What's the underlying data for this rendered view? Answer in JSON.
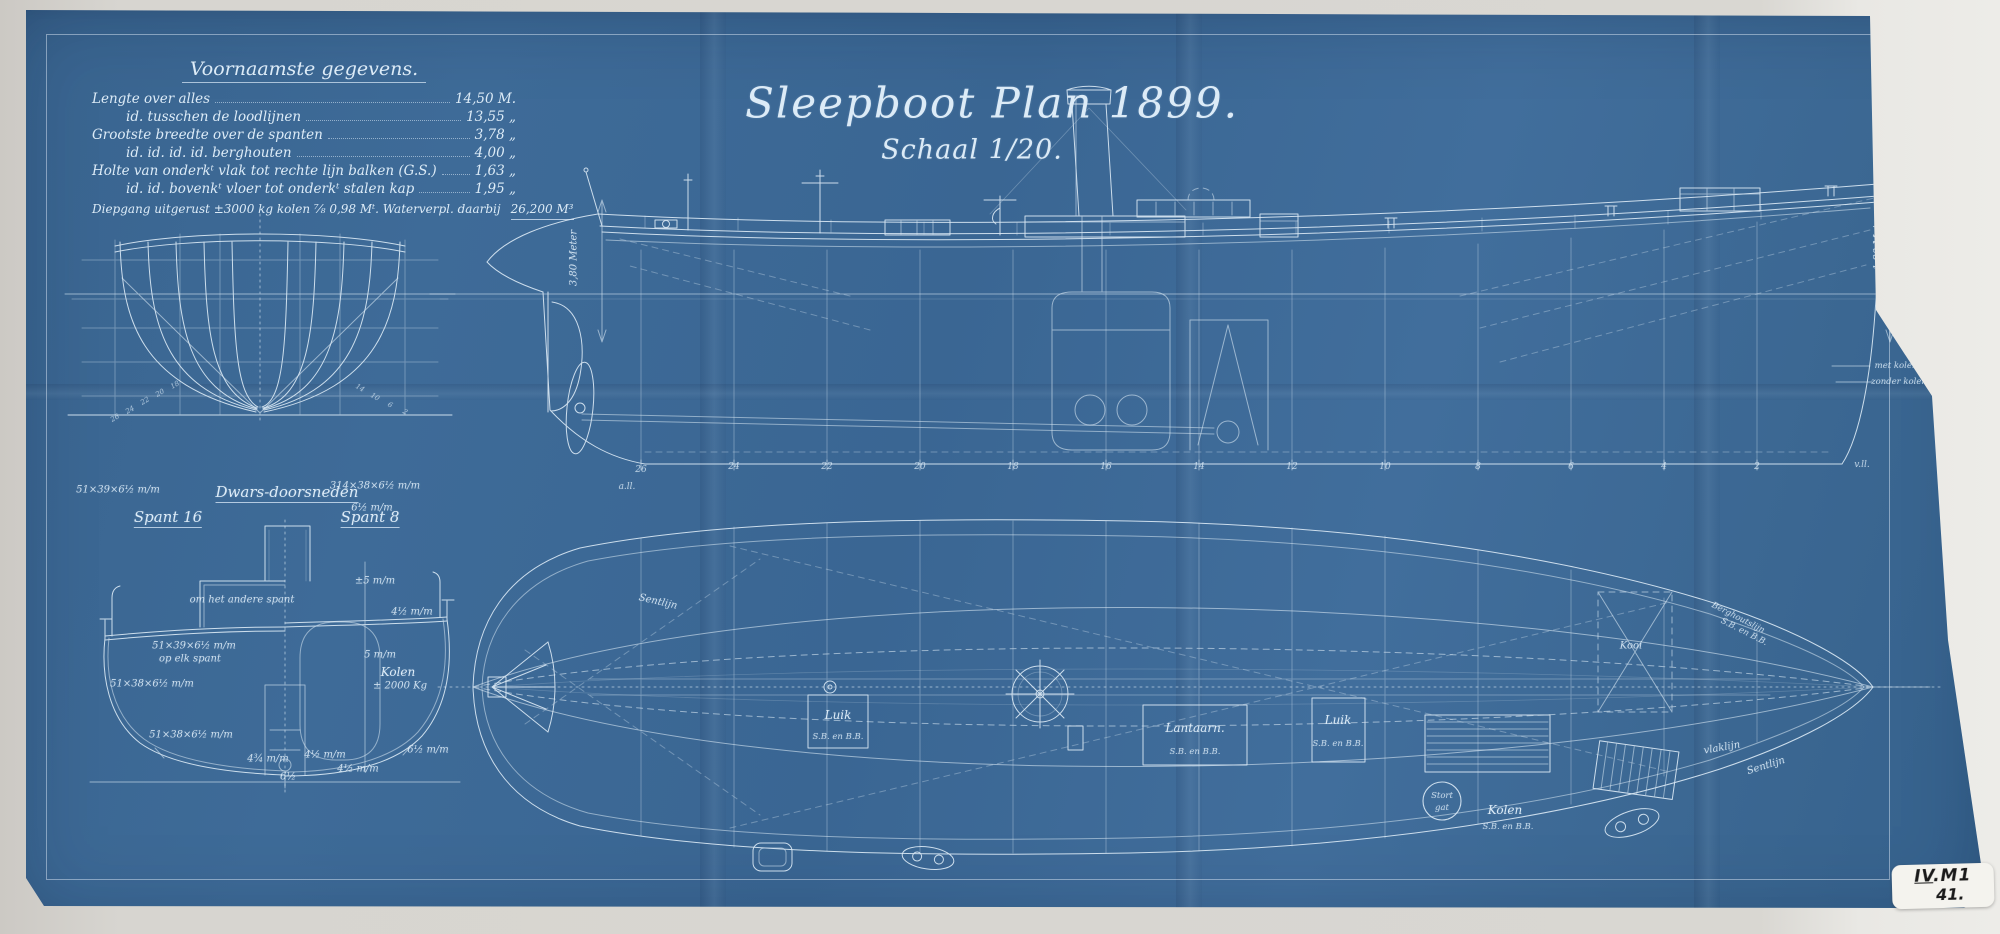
{
  "colors": {
    "paper": "#d9d7d2",
    "blueprint": "#3e6b98",
    "ink": "#dcebf7"
  },
  "title_block": {
    "line1": "Sleepboot Plan 1899.",
    "line2": "Schaal 1/20."
  },
  "data_table": {
    "title": "Voornaamste gegevens.",
    "rows": [
      {
        "label": "Lengte over alles",
        "value": "14,50 M."
      },
      {
        "label": "id.   tusschen de loodlijnen",
        "value": "13,55 „"
      },
      {
        "label": "Grootste breedte over de spanten",
        "value": "3,78 „"
      },
      {
        "label": "id.    id.    id. id. berghouten",
        "value": "4,00 „"
      },
      {
        "label": "Holte van onderkᵗ vlak tot rechte lijn balken (G.S.)",
        "value": "1,63 „"
      },
      {
        "label": "id.   id.  bovenkᵗ vloer tot onderkᵗ stalen kap",
        "value": "1,95 „"
      },
      {
        "label": "Diepgang uitgerust ±3000 kg kolen ⅞ 0,98 Mᵗ.  Waterverpl. daarbij",
        "value": "26,200 M³"
      }
    ]
  },
  "body_plan": {
    "numbers_left": [
      "26",
      "24",
      "22",
      "20",
      "18"
    ],
    "numbers_right": [
      "14",
      "10",
      "6",
      "2"
    ]
  },
  "cross_sections": {
    "title": "Dwars-doorsneden",
    "left_label": "Spant 16",
    "right_label": "Spant 8",
    "annotations": [
      "om het andere spant",
      "51×39×6½ m/m",
      "op elk spant",
      "51×38×6½ m/m",
      "51×38×6½ m/m",
      "4¾ m/m",
      "4½ m/m",
      "4½ m/m",
      "6½ m/m",
      "6½",
      "±5 m/m",
      "4½ m/m",
      "5 m/m",
      "Kolen",
      "± 2000 Kg",
      "314×38×6½ m/m",
      "6½ m/m",
      "51×39×6½ m/m"
    ]
  },
  "side_view": {
    "frames": [
      "26",
      "24",
      "22",
      "20",
      "18",
      "16",
      "14",
      "12",
      "10",
      "8",
      "6",
      "4",
      "2"
    ],
    "aft_label": "a.ll.",
    "fore_label": "v.ll.",
    "dim_left": "3,80 Meter",
    "dim_right": "1,80 Meter",
    "waterline_1": "met kolen",
    "waterline_2": "zonder kolen"
  },
  "deck_plan": {
    "luik1": {
      "t": "Luik",
      "s": "S.B. en B.B."
    },
    "lantaarn": {
      "t": "Lantaarn.",
      "s": "S.B. en B.B."
    },
    "luik2": {
      "t": "Luik",
      "s": "S.B. en B.B."
    },
    "stort1": "Stort",
    "stort2": "gat",
    "kolen1": "Kolen",
    "kolen2": "S.B. en B.B.",
    "kooi": "Kooi",
    "kast1": "Berghoutslijn",
    "kast2": "S.B. en B.B.",
    "vlaklijn": "vlaklijn",
    "sentlijn_r": "Sentlijn",
    "sentlijn_l": "Sentlijn"
  },
  "sticker": {
    "roman": "IV",
    "code": ".M1",
    "number": "41."
  }
}
